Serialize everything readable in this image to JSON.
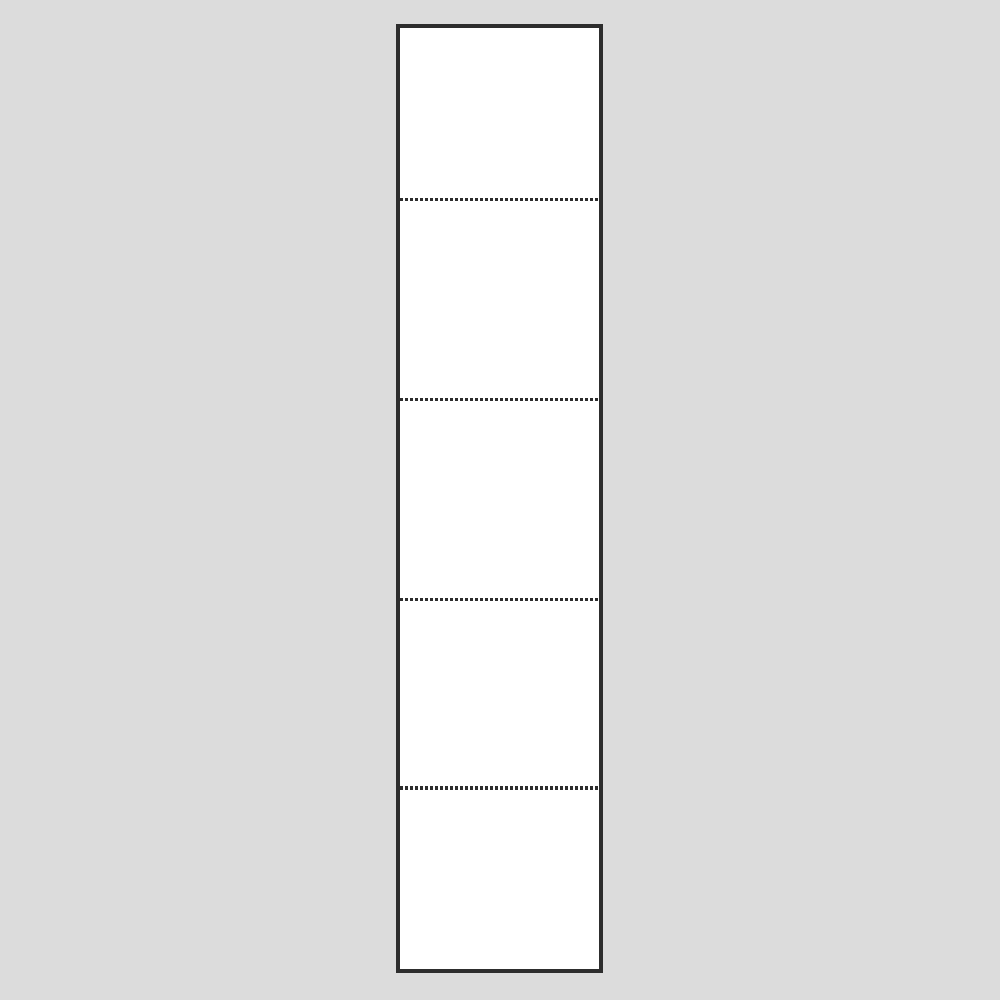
{
  "figure": {
    "description": "Blank vertical white strip divided into five empty segments by four horizontal dotted tear lines",
    "segment_count": 5,
    "separator_count": 4,
    "separator_style": "dotted"
  },
  "colors": {
    "page-bg": "#dcdcdc",
    "panel-fill": "#ffffff",
    "panel-border": "#2d2d2d",
    "separator": "#2d2d2d"
  }
}
